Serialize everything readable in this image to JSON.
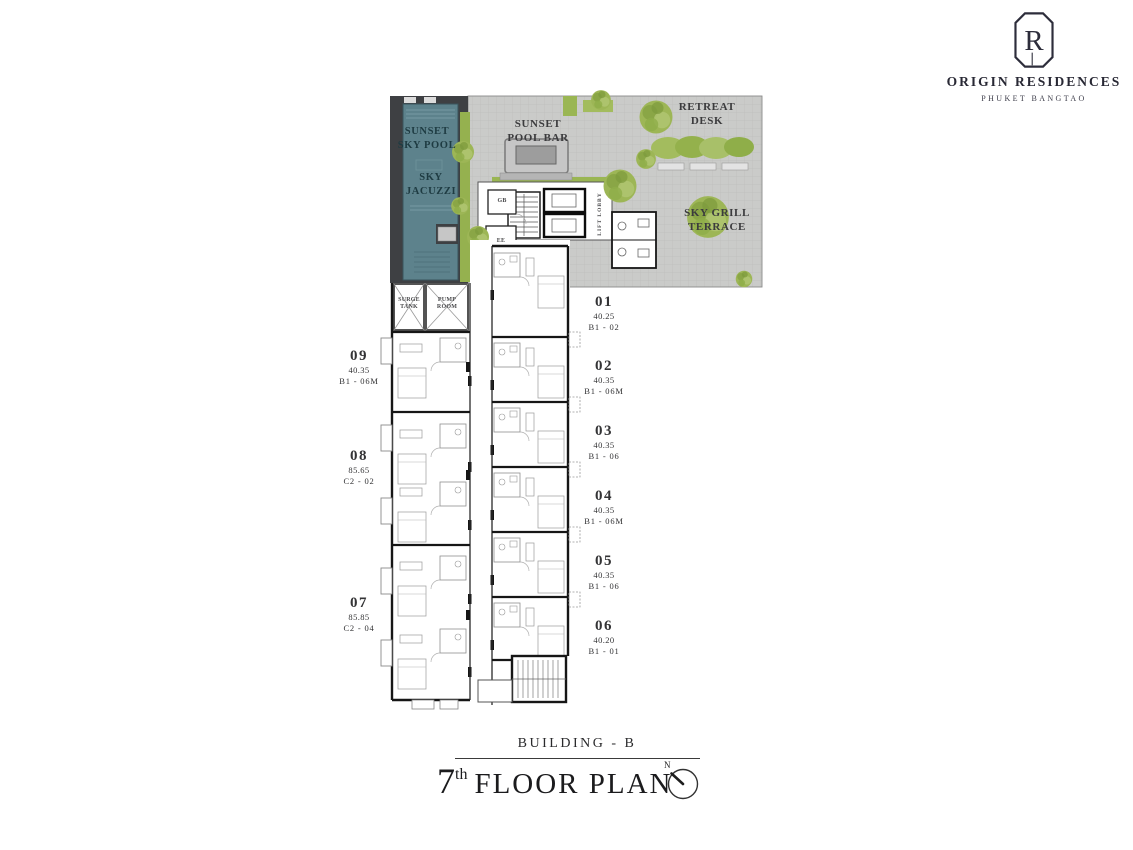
{
  "brand": {
    "initial": "R",
    "name": "ORIGIN RESIDENCES",
    "location": "PHUKET BANGTAO"
  },
  "plan_labels": {
    "sunset_sky_pool": "SUNSET\nSKY POOL",
    "sky_jacuzzi": "SKY\nJACUZZI",
    "sunset_pool_bar": "SUNSET\nPOOL BAR",
    "retreat_desk": "RETREAT\nDESK",
    "sky_grill_terrace": "SKY GRILL\nTERRACE",
    "lift_lobby": "LIFT LOBBY",
    "surge_tank": "SURGE\nTANK",
    "pump_room": "PUMP\nROOM",
    "room_gb": "GB",
    "room_ee": "EE"
  },
  "units": [
    {
      "number": "01",
      "area": "40.25",
      "type": "B1 - 02"
    },
    {
      "number": "02",
      "area": "40.35",
      "type": "B1 - 06M"
    },
    {
      "number": "03",
      "area": "40.35",
      "type": "B1 - 06"
    },
    {
      "number": "04",
      "area": "40.35",
      "type": "B1 - 06M"
    },
    {
      "number": "05",
      "area": "40.35",
      "type": "B1 - 06"
    },
    {
      "number": "06",
      "area": "40.20",
      "type": "B1 - 01"
    },
    {
      "number": "07",
      "area": "85.85",
      "type": "C2 - 04"
    },
    {
      "number": "08",
      "area": "85.65",
      "type": "C2 - 02"
    },
    {
      "number": "09",
      "area": "40.35",
      "type": "B1 - 06M"
    }
  ],
  "title": {
    "building": "BUILDING - B",
    "floor_number": "7",
    "floor_ordinal": "th",
    "floor_text": "FLOOR PLAN",
    "north": "N"
  },
  "colors": {
    "terrace_paving": "#cacbc9",
    "pool_deck": "#3e4043",
    "pool_water": "#5d828c",
    "greenery": "#95b14f",
    "wall": "#161616",
    "text": "#3b3b3d"
  }
}
